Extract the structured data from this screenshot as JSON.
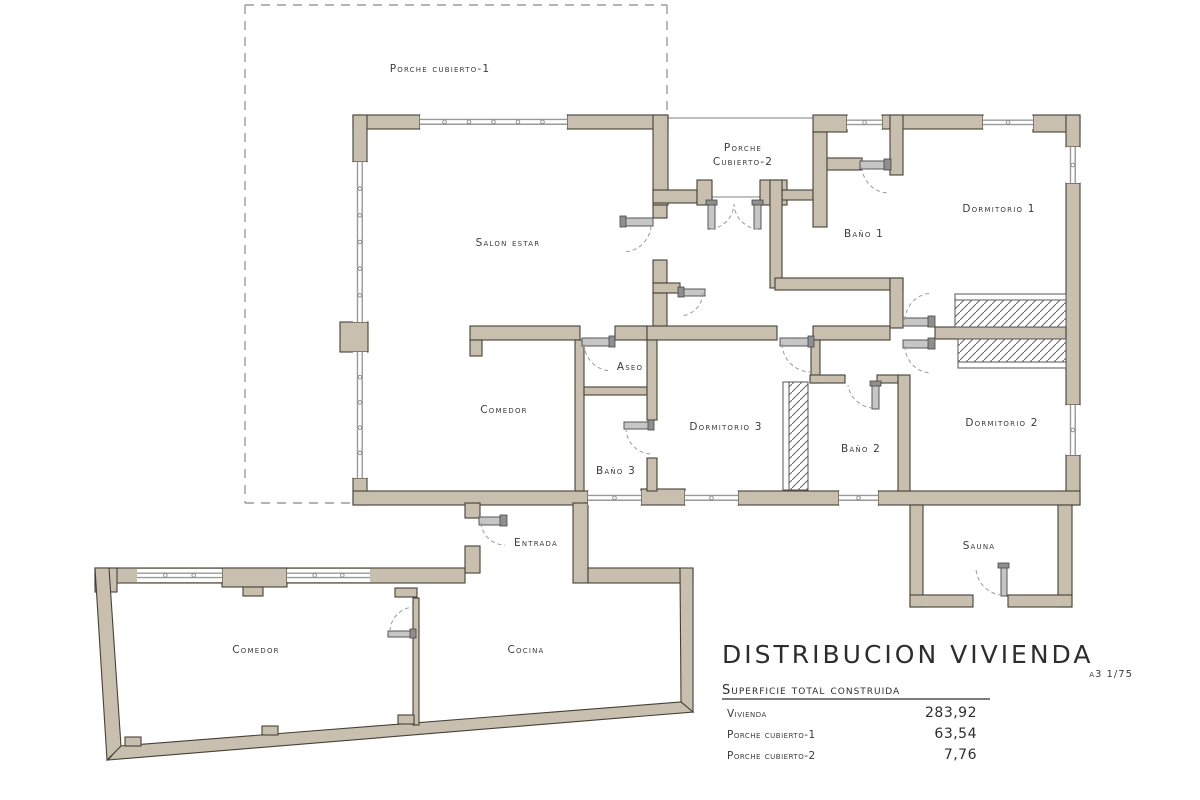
{
  "drawing": {
    "rooms": {
      "porche1": "Porche cubierto-1",
      "salon": "Salon estar",
      "porche2_line1": "Porche",
      "porche2_line2": "Cubierto-2",
      "bano1": "Baño 1",
      "dormitorio1": "Dormitorio 1",
      "aseo": "Aseo",
      "comedor": "Comedor",
      "dormitorio3": "Dormitorio 3",
      "bano3": "Baño 3",
      "bano2": "Baño 2",
      "dormitorio2": "Dormitorio 2",
      "entrada": "Entrada",
      "sauna": "Sauna",
      "comedor_bajo": "Comedor",
      "cocina": "Cocina"
    },
    "titleblock": {
      "title": "DISTRIBUCION VIVIENDA",
      "scale": "a3 1/75",
      "subtitle": "Superficie total construida",
      "rows": [
        {
          "label": "Vivienda",
          "value": "283,92"
        },
        {
          "label": "Porche cubierto-1",
          "value": "63,54"
        },
        {
          "label": "Porche cubierto-2",
          "value": "7,76"
        }
      ]
    },
    "colors": {
      "wall_fill": "#c9bfae",
      "wall_outline": "#454135",
      "line_gray": "#9a9a9a",
      "text": "#3b3b3b",
      "background": "#ffffff"
    }
  }
}
